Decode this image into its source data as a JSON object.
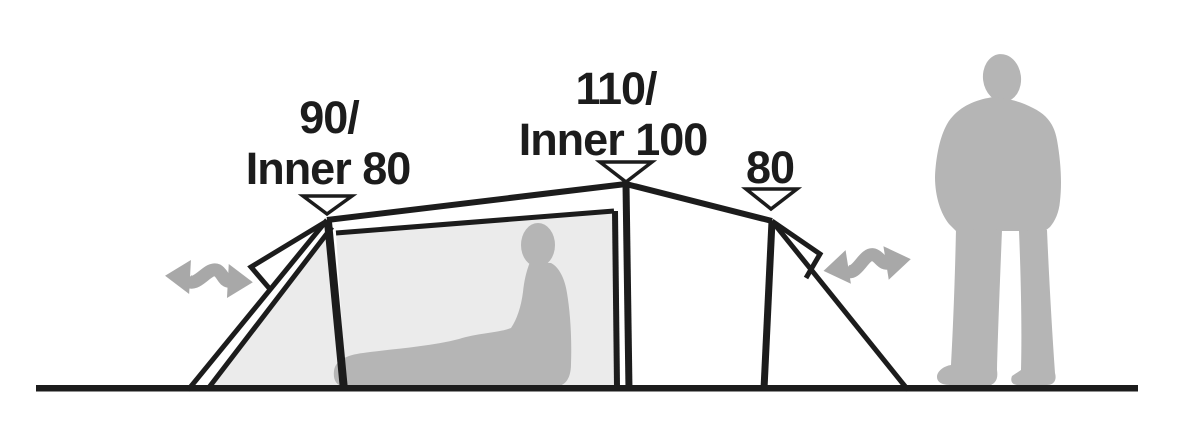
{
  "diagram": {
    "type": "tent-side-profile-dimension-diagram",
    "labels": {
      "pole1": {
        "line1": "90/",
        "line2": "Inner 80"
      },
      "pole2": {
        "line1": "110/",
        "line2": "Inner 100"
      },
      "pole3": {
        "line1": "80"
      }
    },
    "colors": {
      "line": "#1c1c1c",
      "fill_light": "#ebebeb",
      "silhouette_gray": "#b5b5b5",
      "arrow_gray": "#a8a8a8",
      "background": "#ffffff"
    },
    "icons": {
      "height_marker": "height-marker-triangle-icon",
      "left_arrow": "ventilation-arrow-left-icon",
      "right_arrow": "ventilation-arrow-right-icon"
    }
  }
}
